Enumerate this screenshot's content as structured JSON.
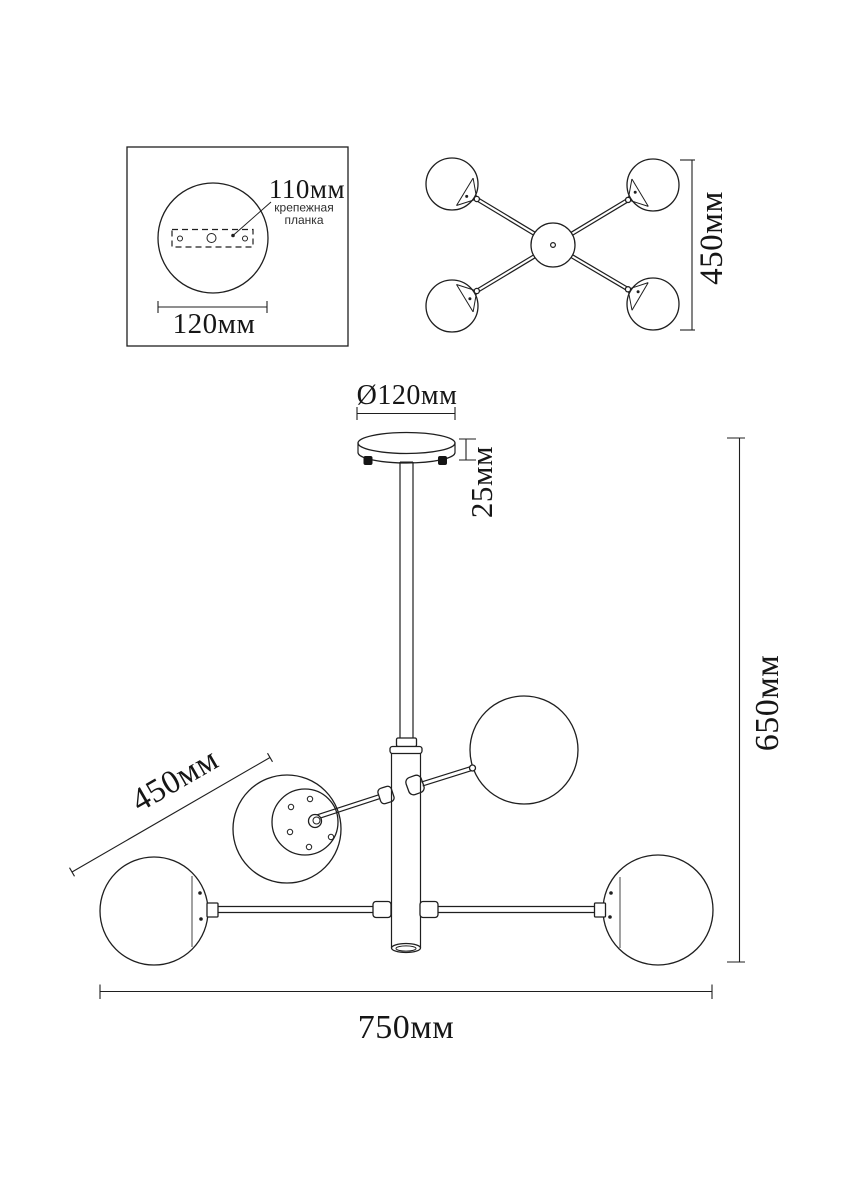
{
  "drawing": {
    "background": "#ffffff",
    "ink_color": "#1f1f1f",
    "chord_color": "#7a7a7a"
  },
  "mount_detail": {
    "plate_offset_label": "110мм",
    "plate_note_line1": "крепежная",
    "plate_note_line2": "планка",
    "base_width_label": "120мм"
  },
  "top_view": {
    "span_label": "450мм"
  },
  "front_view": {
    "canopy_diameter_label": "Ø120мм",
    "canopy_height_label": "25мм",
    "overall_height_label": "650мм",
    "arm_length_label": "450мм",
    "overall_width_label": "750мм"
  }
}
